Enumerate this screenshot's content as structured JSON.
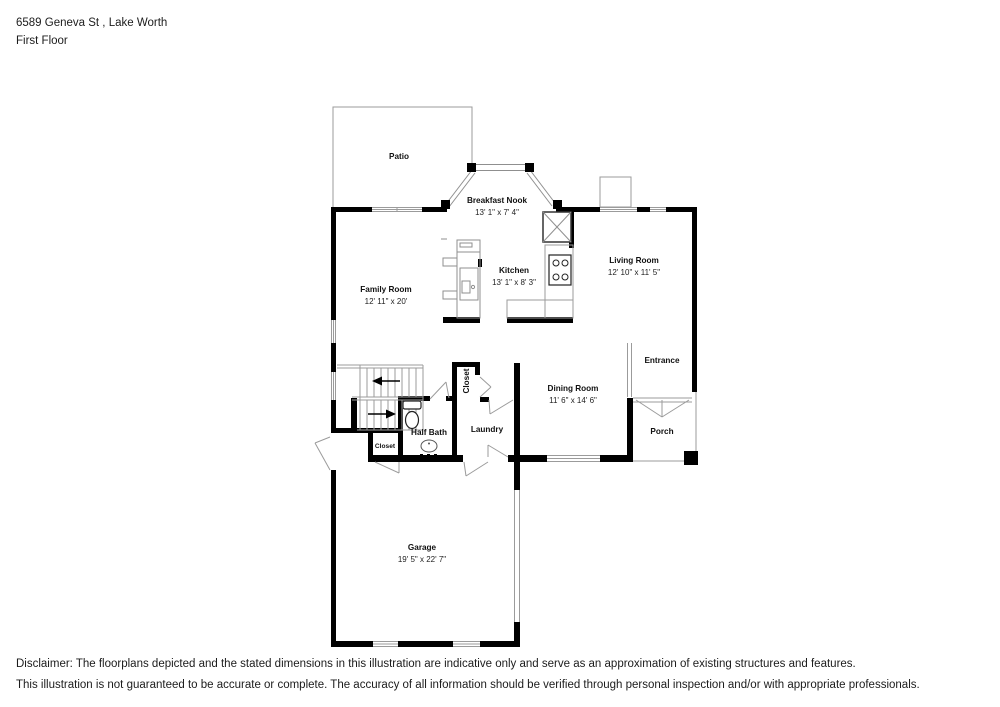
{
  "header": {
    "address": "6589 Geneva St , Lake Worth",
    "floor_label": "First Floor"
  },
  "rooms": {
    "patio": {
      "name": "Patio"
    },
    "breakfast_nook": {
      "name": "Breakfast Nook",
      "dims": "13' 1\" x 7' 4\""
    },
    "kitchen": {
      "name": "Kitchen",
      "dims": "13' 1\" x 8' 3\""
    },
    "living_room": {
      "name": "Living Room",
      "dims": "12' 10\" x 11' 5\""
    },
    "family_room": {
      "name": "Family Room",
      "dims": "12' 11\" x 20'"
    },
    "entrance": {
      "name": "Entrance"
    },
    "dining_room": {
      "name": "Dining Room",
      "dims": "11' 6\" x 14' 6\""
    },
    "hall_closet": {
      "name": "Closet"
    },
    "laundry": {
      "name": "Laundry"
    },
    "half_bath": {
      "name": "Half Bath"
    },
    "stair_closet": {
      "name": "Closet"
    },
    "porch": {
      "name": "Porch"
    },
    "garage": {
      "name": "Garage",
      "dims": "19' 5\" x 22' 7\""
    }
  },
  "disclaimer": {
    "line1": "Disclaimer: The floorplans depicted and the stated dimensions in this illustration are indicative only and serve as an approximation of existing structures and features.",
    "line2": "This illustration is not guaranteed to be accurate or complete. The accuracy of all information should be verified through personal inspection and/or with appropriate professionals."
  },
  "colors": {
    "wall": "#000000",
    "thin_line": "#9b9b9b",
    "text": "#1c1c1c"
  }
}
